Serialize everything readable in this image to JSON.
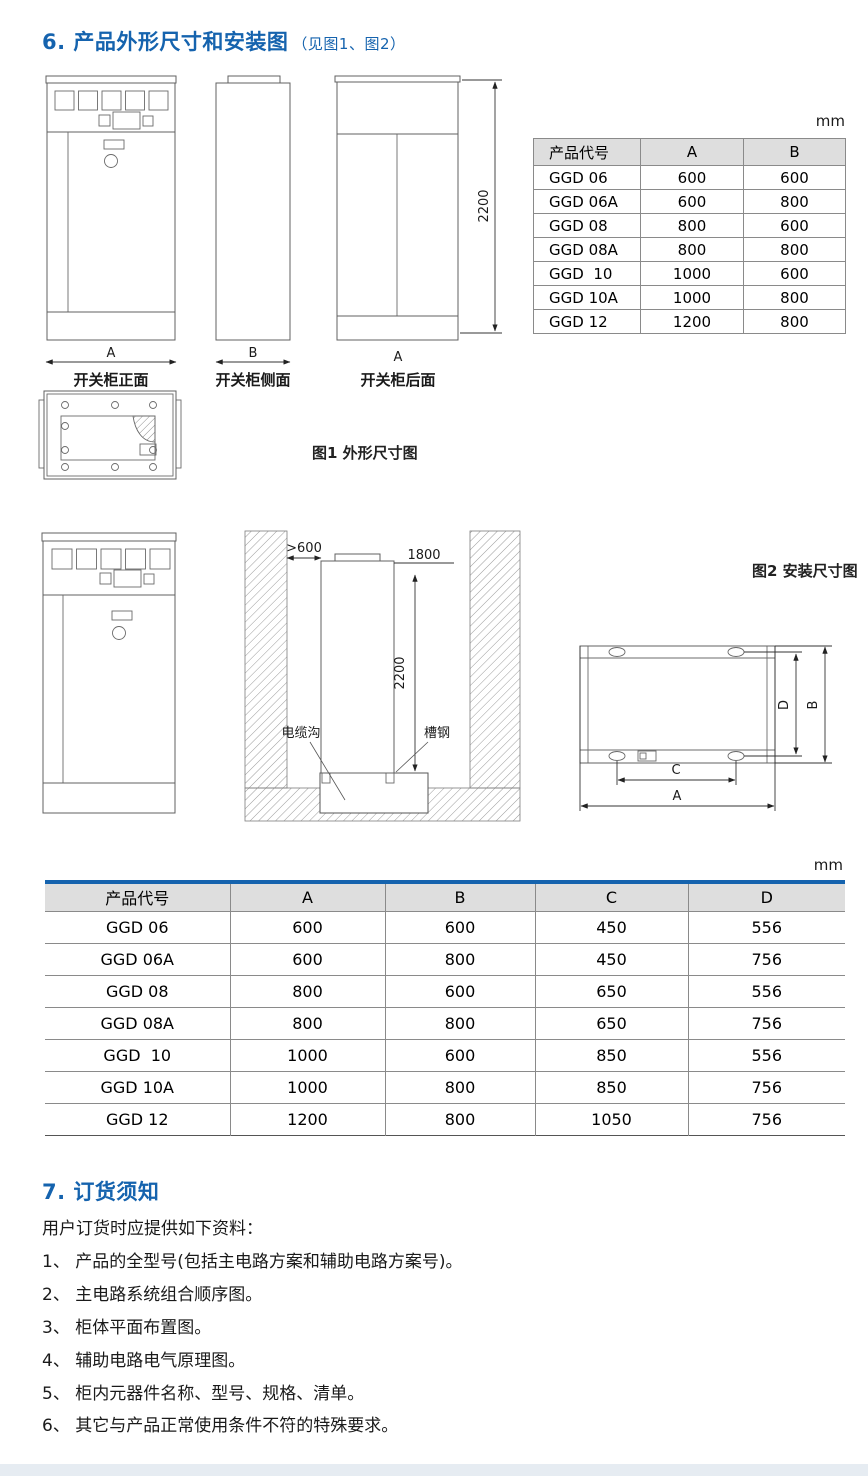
{
  "colors": {
    "accent": "#1563ae",
    "table_header_bg": "#dedede",
    "table_blue_border": "#1563ae",
    "line_dark": "#4a4a4a"
  },
  "section6": {
    "title": "6. 产品外形尺寸和安装图",
    "title_note": "（见图1、图2）",
    "unit": "mm",
    "front_label": "开关柜正面",
    "side_label": "开关柜侧面",
    "rear_label": "开关柜后面",
    "dim_a": "A",
    "dim_b": "B",
    "dim_height": "2200",
    "fig1_caption": "图1 外形尺寸图"
  },
  "install": {
    "fig2_caption": "图2 安装尺寸图",
    "unit": "mm",
    "clearance": ">600",
    "dim_1800": "1800",
    "dim_2200": "2200",
    "cable_trench_label": "电缆沟",
    "channel_steel_label": "槽钢",
    "dim_a": "A",
    "dim_b": "B",
    "dim_c": "C",
    "dim_d": "D"
  },
  "table1": {
    "headers": [
      "产品代号",
      "A",
      "B"
    ],
    "rows": [
      [
        "GGD 06",
        "600",
        "600"
      ],
      [
        "GGD 06A",
        "600",
        "800"
      ],
      [
        "GGD 08",
        "800",
        "600"
      ],
      [
        "GGD 08A",
        "800",
        "800"
      ],
      [
        "GGD  10",
        "1000",
        "600"
      ],
      [
        "GGD 10A",
        "1000",
        "800"
      ],
      [
        "GGD 12",
        "1200",
        "800"
      ]
    ]
  },
  "table2": {
    "headers": [
      "产品代号",
      "A",
      "B",
      "C",
      "D"
    ],
    "rows": [
      [
        "GGD 06",
        "600",
        "600",
        "450",
        "556"
      ],
      [
        "GGD 06A",
        "600",
        "800",
        "450",
        "756"
      ],
      [
        "GGD 08",
        "800",
        "600",
        "650",
        "556"
      ],
      [
        "GGD 08A",
        "800",
        "800",
        "650",
        "756"
      ],
      [
        "GGD  10",
        "1000",
        "600",
        "850",
        "556"
      ],
      [
        "GGD 10A",
        "1000",
        "800",
        "850",
        "756"
      ],
      [
        "GGD 12",
        "1200",
        "800",
        "1050",
        "756"
      ]
    ]
  },
  "section7": {
    "title": "7. 订货须知",
    "intro": "用户订货时应提供如下资料：",
    "items": [
      "1、 产品的全型号(包括主电路方案和辅助电路方案号)。",
      "2、 主电路系统组合顺序图。",
      "3、 柜体平面布置图。",
      "4、 辅助电路电气原理图。",
      "5、 柜内元器件名称、型号、规格、清单。",
      "6、 其它与产品正常使用条件不符的特殊要求。"
    ]
  }
}
